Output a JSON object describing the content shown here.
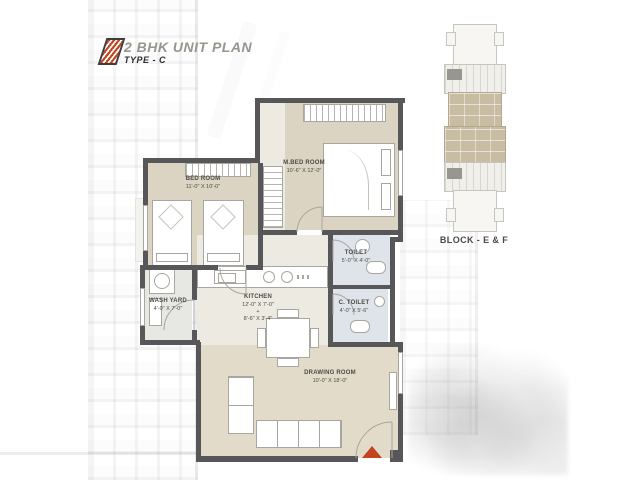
{
  "title": {
    "main": "2 BHK UNIT PLAN",
    "sub": "TYPE - C"
  },
  "key_plan": {
    "caption": "BLOCK - E & F"
  },
  "rooms": {
    "bed": {
      "name": "BED ROOM",
      "dims": "11'-0\" X 10'-0\""
    },
    "mbed": {
      "name": "M.BED ROOM",
      "dims": "10'-6\" X 12'-0\""
    },
    "toilet": {
      "name": "TOILET",
      "dims": "5'-0\" X 4'-0\""
    },
    "ctoilet": {
      "name": "C. TOILET",
      "dims": "4'-0\" X 5'-6\""
    },
    "kitchen": {
      "name": "KITCHEN",
      "dims": "12'-0\" X 7'-0\"",
      "plus": "+",
      "dims2": "8'-6\" X 3'-4\""
    },
    "wash": {
      "name": "WASH YARD",
      "dims": "4'-0\" X 7'-0\""
    },
    "drawing": {
      "name": "DRAWING ROOM",
      "dims": "10'-0\" X 18'-0\""
    }
  },
  "colors": {
    "accent": "#c2451f",
    "wall": "#57575a",
    "room_fill": "#dcd4c2",
    "floor_light": "#edeae1",
    "bath_fill": "#dee4e9",
    "keyplan_highlight": "#c8bca3"
  }
}
